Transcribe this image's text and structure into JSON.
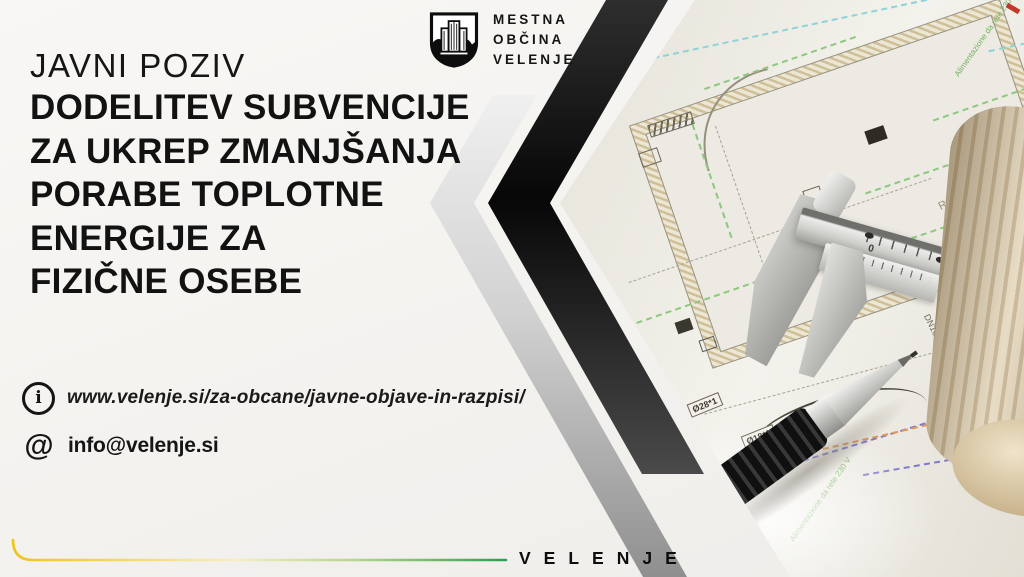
{
  "poster": {
    "logo": {
      "municipality_lines": [
        "MESTNA",
        "OBČINA",
        "VELENJE"
      ]
    },
    "headline": {
      "kicker": "JAVNI POZIV",
      "lines": [
        "DODELITEV SUBVENCIJE",
        "ZA UKREP ZMANJŠANJA",
        "PORABE TOPLOTNE",
        "ENERGIJE ZA",
        "FIZIČNE OSEBE"
      ]
    },
    "contact": {
      "website": "www.velenje.si/za-obcane/javne-objave-in-razpisi/",
      "email": "info@velenje.si"
    },
    "footer": {
      "wordmark": "VELENJE"
    },
    "photo": {
      "drawing_labels": {
        "rele": "Relè",
        "d18": "Ø18*1",
        "d28": "Ø28*1",
        "dn16": "DN16",
        "power1": "Alimentazione da rete 230 V",
        "power2": "Alimentazione da rete 230 V"
      },
      "caliper_scale": {
        "zero": "0",
        "four": "4"
      }
    },
    "colors": {
      "ink": "#111111",
      "accent-yellow": "#f0c419",
      "accent-green": "#2f9e4f",
      "band-black": "#0d0d0d",
      "band-silver": "#b9b9b9",
      "paper": "#eceae2"
    }
  }
}
